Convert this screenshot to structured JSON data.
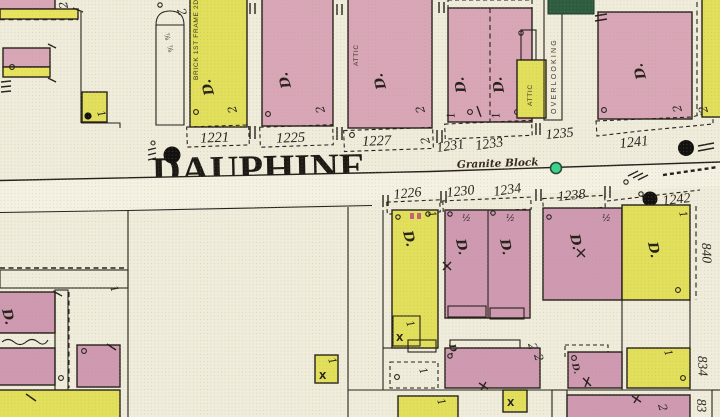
{
  "street": {
    "name": "DAUPHINE",
    "paving": "Granite Block"
  },
  "addresses": {
    "top": [
      "1221",
      "1225",
      "1227",
      "1231",
      "1233",
      "1235",
      "1241"
    ],
    "bottom": [
      "1226",
      "1230",
      "1234",
      "1238",
      "1242"
    ],
    "side": [
      "840",
      "834",
      "83"
    ]
  },
  "symbols": {
    "dwelling": "D.",
    "stories_two": "2",
    "stories_one": "1",
    "half_story": "½",
    "x_mark": "X",
    "eighth": "⅞",
    "attic": "ATTIC",
    "overlooking": "OVERLOOKING",
    "construction_note": "BRICK 1ST FRAME 2D"
  },
  "palette": {
    "paper": "#f0ecdb",
    "street_band": "#f5f2e4",
    "pink_building": "#d9a6b8",
    "pink_building_deep": "#cf9ab1",
    "yellow_building": "#e2df5b",
    "label_strip": "#e7e35c",
    "line": "#26211b",
    "hydrant_black": "#141210",
    "valve_green": "#3ed08d",
    "green_patch": "#2e5c40"
  }
}
